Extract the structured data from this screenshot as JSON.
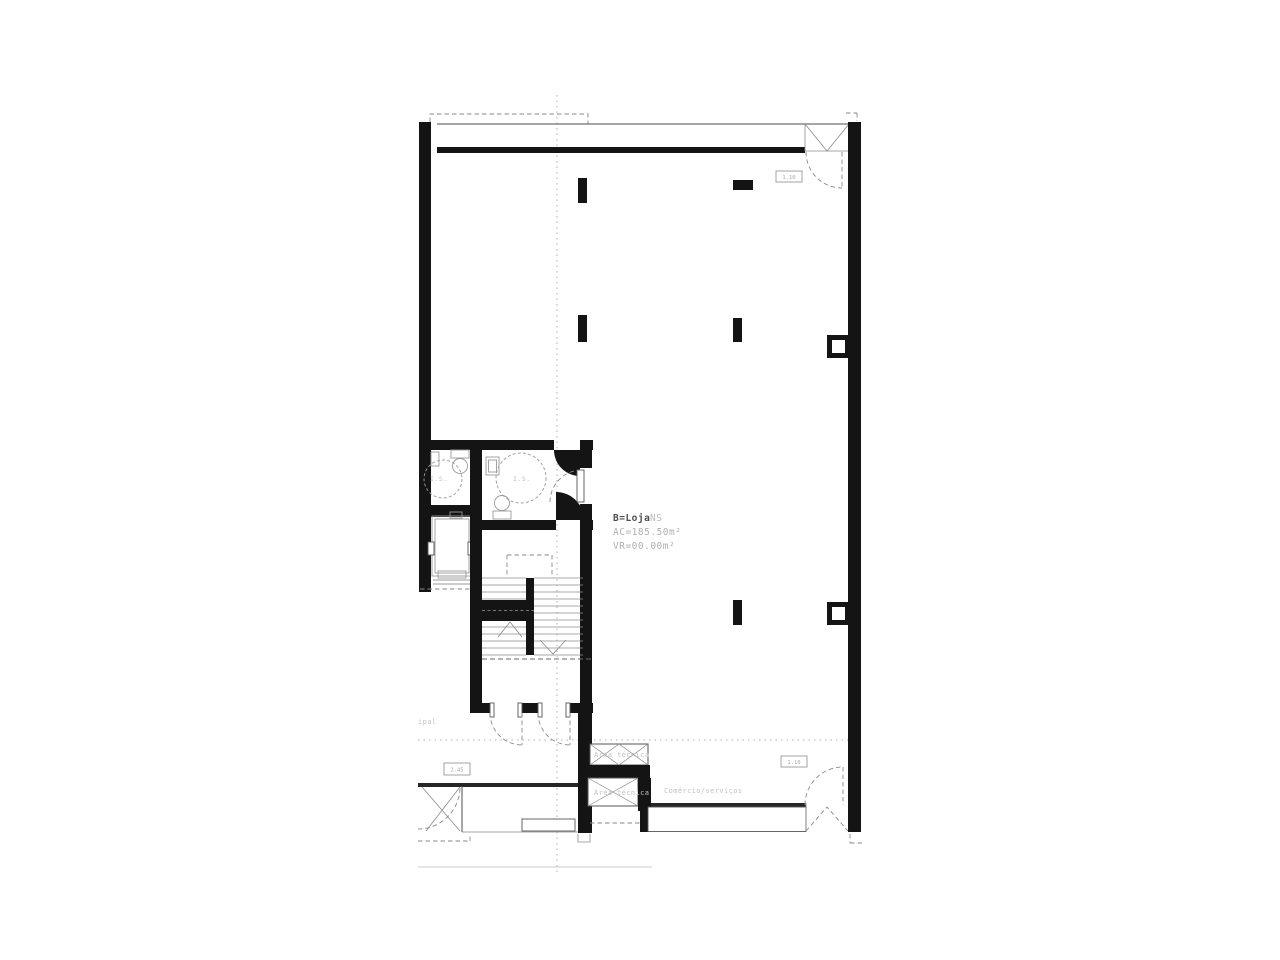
{
  "plan": {
    "unit": {
      "bold": "B=Loja",
      "suffix": "NS",
      "area": "AC=185.50m²",
      "void": "VR=00.00m²"
    },
    "labels": {
      "bath1": "I.S.",
      "bath2": "I.S.",
      "tech_upper": "Área técnica",
      "tech_lower": "Área técnica",
      "commerce": "Comércio/serviços",
      "street_fragment": "ipal"
    },
    "dims": {
      "entrance_top": "1.10",
      "entrance_bottom": "1.10",
      "left": "2.45"
    },
    "colors": {
      "wall": "#141414",
      "line": "#4d4d4d",
      "light_line": "#8a8a8a",
      "fixture": "#9a9a9a",
      "label": "#b8b8b8",
      "label_dark": "#4d4d4d",
      "axis_dotted": "#b0b0b0",
      "background": "#ffffff"
    }
  }
}
